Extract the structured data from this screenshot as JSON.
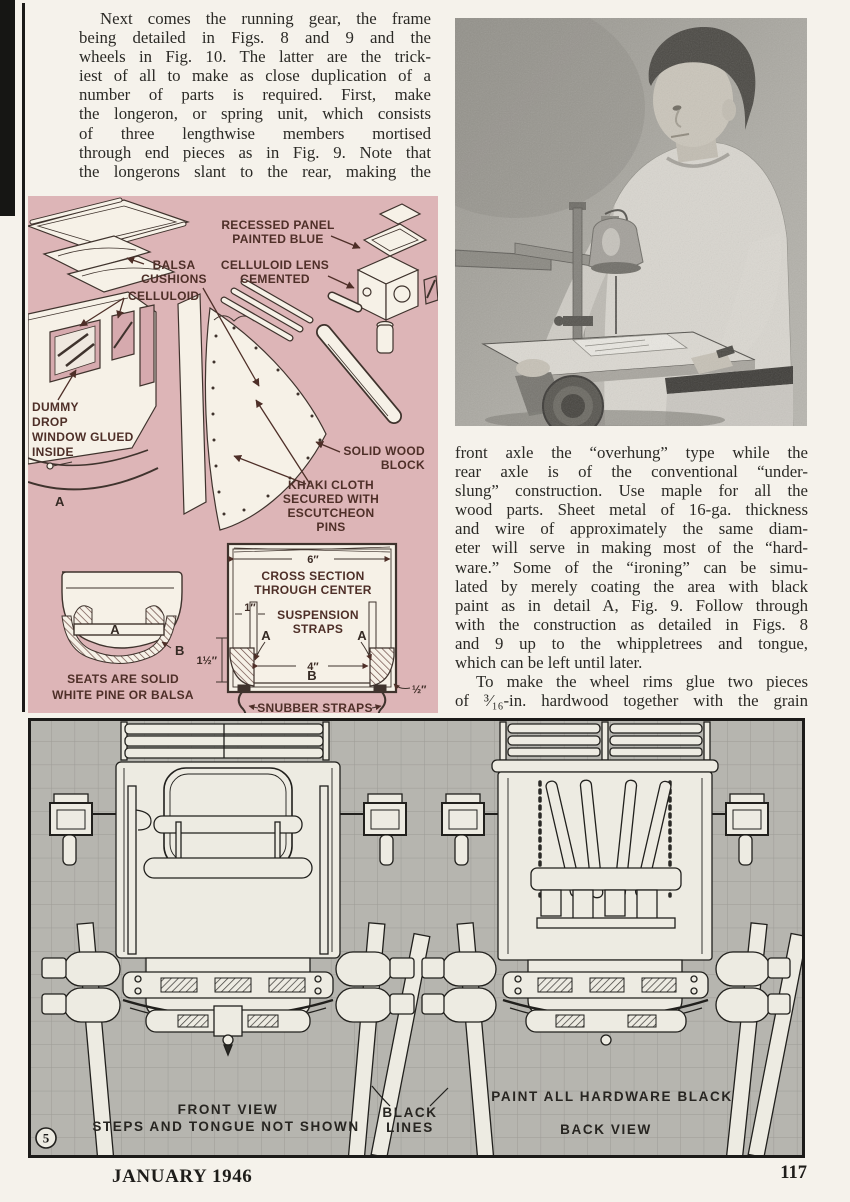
{
  "article": {
    "col1": [
      "Next comes the running gear, the frame",
      "being detailed in Figs. 8 and 9 and the",
      "wheels in Fig. 10.  The latter are the trick-",
      "iest of all to make as close duplication of a",
      "number of parts is required.  First, make",
      "the longeron, or spring unit, which consists",
      "of three lengthwise members mortised",
      "through end pieces as in Fig. 9.  Note that",
      "the longerons slant to the rear, making the"
    ],
    "col2_p1": [
      "front axle the “overhung” type while the",
      "rear axle is of the conventional “under-",
      "slung” construction.  Use maple for all the",
      "wood parts.  Sheet metal of 16-ga. thickness",
      "and wire of approximately the same diam-",
      "eter will serve in making most of the “hard-",
      "ware.”  Some of the “ironing” can be simu-",
      "lated by merely coating the area with black",
      "paint as in detail A, Fig. 9.  Follow through",
      "with the construction as detailed in Figs. 8",
      "and 9 up to the whippletrees and tongue,",
      "which can be left until later."
    ],
    "col2_p2": [
      "To make the wheel rims glue two pieces",
      "of ³⁄₁₆-in. hardwood together with the grain"
    ]
  },
  "pink": {
    "recessed": [
      "RECESSED PANEL",
      "PAINTED BLUE"
    ],
    "balsa": [
      "BALSA",
      "CUSHIONS"
    ],
    "lens": [
      "CELLULOID LENS",
      "CEMENTED"
    ],
    "celluloid": "CELLULOID",
    "dummy": [
      "DUMMY",
      "DROP",
      "WINDOW GLUED",
      "INSIDE"
    ],
    "body_a": "A",
    "solid": [
      "SOLID WOOD",
      "BLOCK"
    ],
    "khaki": [
      "KHAKI CLOTH",
      "SECURED WITH",
      "ESCUTCHEON",
      "PINS"
    ],
    "seats": [
      "SEATS ARE SOLID",
      "WHITE PINE OR BALSA"
    ],
    "seat_a": "A",
    "seat_b": "B",
    "dim_6": "6″",
    "cross": [
      "CROSS SECTION",
      "THROUGH CENTER"
    ],
    "dim_1": "1″",
    "susp": [
      "SUSPENSION",
      "STRAPS"
    ],
    "strap_a_l": "A",
    "strap_a_r": "A",
    "dim_1_5": "1½″",
    "dim_4": "4″",
    "sec_b": "B",
    "dim_half": "½″",
    "snubber": "SNUBBER STRAPS"
  },
  "figure": {
    "front_view": "FRONT VIEW",
    "steps": "STEPS AND TONGUE NOT SHOWN",
    "black": [
      "BLACK",
      "LINES"
    ],
    "paint": "PAINT ALL HARDWARE BLACK",
    "back_view": "BACK VIEW",
    "number": "5"
  },
  "footer": {
    "left": "JANUARY 1946",
    "right": "117"
  },
  "colors": {
    "pink_bg": "#ddb5b7",
    "label_maroon": "#4e2f28",
    "grid_gray": "#b6b5af",
    "ink": "#2b2a26"
  }
}
